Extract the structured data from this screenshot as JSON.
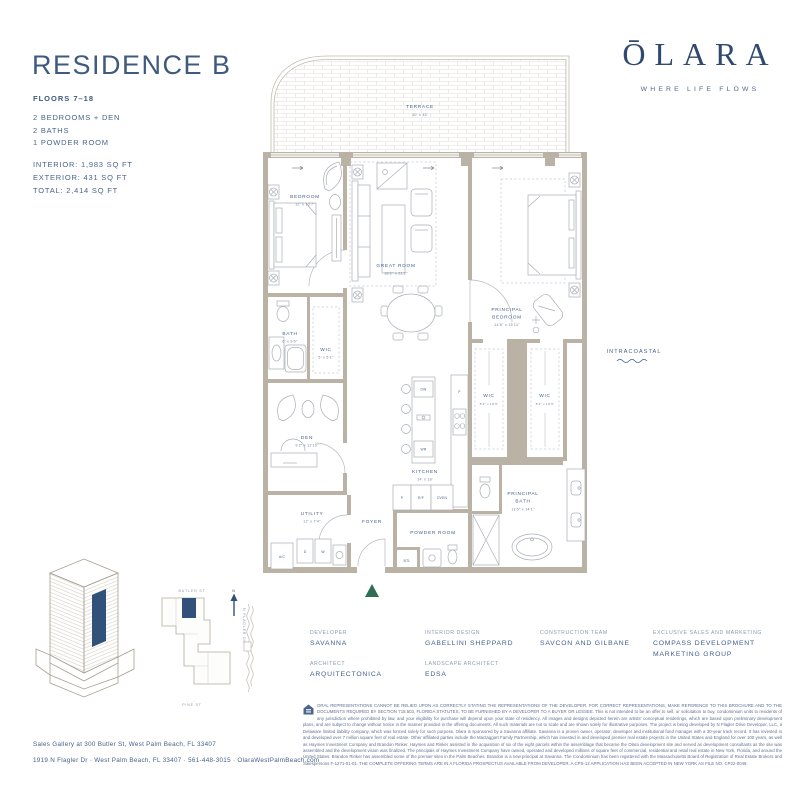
{
  "colors": {
    "navy": "#3e5a7e",
    "navy_dark": "#2f4a6e",
    "wall": "#b9b2a5",
    "green": "#2f6e55"
  },
  "header": {
    "title": "RESIDENCE B",
    "floors": "FLOORS 7–18",
    "features": [
      "2 BEDROOMS + DEN",
      "2 BATHS",
      "1 POWDER ROOM"
    ],
    "areas": [
      "INTERIOR: 1,983 SQ FT",
      "EXTERIOR: 431 SQ FT",
      "TOTAL: 2,414 SQ FT"
    ]
  },
  "brand": {
    "logo": "ŌLARA",
    "tagline": "WHERE LIFE FLOWS"
  },
  "floorplan": {
    "rooms": {
      "terrace": {
        "name": "TERRACE",
        "dims": "10' x 45'"
      },
      "bedroom": {
        "name": "BEDROOM",
        "dims": "12' x 13'7\""
      },
      "great_room": {
        "name": "GREAT ROOM",
        "dims": "18'2\" x 21'2\""
      },
      "principal_bedroom": {
        "line1": "PRINCIPAL",
        "line2": "BEDROOM",
        "dims": "14'8\" x 15'11\""
      },
      "bath": {
        "name": "BATH",
        "dims": "6' x 9'6\""
      },
      "wic_small": {
        "name": "WIC",
        "dims": "5' x 5'1\""
      },
      "den": {
        "name": "DEN",
        "dims": "9'2\" x 11'10\""
      },
      "utility": {
        "name": "UTILITY",
        "dims": "12' x 7'4\""
      },
      "kitchen": {
        "name": "KITCHEN",
        "dims": "14' x 18'"
      },
      "foyer": {
        "name": "FOYER"
      },
      "powder_room": {
        "name": "POWDER ROOM"
      },
      "wic_left": {
        "name": "WIC",
        "dims": "5'3\" x 10'3\""
      },
      "wic_right": {
        "name": "WIC",
        "dims": "5'3\" x 10'3\""
      },
      "principal_bath": {
        "line1": "PRINCIPAL",
        "line2": "BATH",
        "dims": "11'5\" x 14'1\""
      }
    },
    "fixtures": {
      "dw": "DW",
      "wr": "WR",
      "pantry": "P",
      "p": "P",
      "rf": "R/F",
      "oven": "OVEN",
      "btl": "BTL",
      "ac": "A/C",
      "d": "D",
      "w": "W"
    },
    "annotation": "INTRACOASTAL"
  },
  "keyplan": {
    "street_top": "BUTLER ST",
    "street_bottom": "PINE ST",
    "street_right": "N FLAGLER DR",
    "north_label": "N"
  },
  "credits": [
    {
      "label": "DEVELOPER",
      "value": "SAVANNA"
    },
    {
      "label": "ARCHITECT",
      "value": "ARQUITECTONICA"
    },
    {
      "label": "INTERIOR DESIGN",
      "value": "GABELLINI SHEPPARD"
    },
    {
      "label": "LANDSCAPE ARCHITECT",
      "value": "EDSA"
    },
    {
      "label": "CONSTRUCTION TEAM",
      "value": "SAVCON AND GILBANE"
    },
    {
      "label": "EXCLUSIVE SALES AND MARKETING",
      "value": "COMPASS DEVELOPMENT MARKETING GROUP"
    }
  ],
  "legal": "ORAL REPRESENTATIONS CANNOT BE RELIED UPON AS CORRECTLY STATING THE REPRESENTATIONS OF THE DEVELOPER. FOR CORRECT REPRESENTATIONS, MAKE REFERENCE TO THIS BROCHURE AND TO THE DOCUMENTS REQUIRED BY SECTION 718.503, FLORIDA STATUTES, TO BE FURNISHED BY A DEVELOPER TO A BUYER OR LESSEE. This is not intended to be an offer to sell, or solicitation to buy, condominium units to residents of any jurisdiction where prohibited by law, and your eligibility for purchase will depend upon your state of residency. All images and designs depicted herein are artists' conceptual renderings, which are based upon preliminary development plans, and are subject to change without notice in the manner provided in the offering documents. All such materials are not to scale and are shown solely for illustrative purposes. The project is being developed by N Flagler Drive Developer, LLC, a Delaware limited liability company, which was formed solely for such purpose. Olara is sponsored by a Savanna affiliate. Savanna is a proven owner, operator, developer and institutional fund manager with a 30-year track record. It has invested in and developed over 7 million square feet of real estate. Other affiliated parties include the Mactaggart Family Partnership, which has invested in and developed premier real estate projects in the United States and England for over 100 years, as well as Haymes Investment Company and Brandon Rinker. Haymes and Rinker assisted in the acquisition of six of the eight parcels within the assemblage that became the Olara development site and served as development consultants as the site was assembled and the development vision was finalized. The principals of Haymes Investment Company have owned, operated and developed millions of square feet of commercial, residential and retail real estate in New York, Florida, and around the United States. Brandon Rinker has assembled some of the premier sites in the Palm Beaches. Brandon is a new principal at Savanna. The Condominium has been registered with the Massachusetts Board of Registration of Real Estate Brokers and Salespersons F-1271-01-01. THE COMPLETE OFFERING TERMS ARE IN A FLORIDA PROSPECTUS AVAILABLE FROM DEVELOPER. A CPS-12 APPLICATION HAS BEEN ACCEPTED IN NEW YORK AS FILE NO. CP22-0049.",
  "footer": {
    "line1": "Sales Gallery at 300 Butler St, West Palm Beach, FL 33407",
    "line2": "1919 N Flagler Dr  ·  West Palm Beach, FL 33407  ·  561-448-3015  ·  OlaraWestPalmBeach.com"
  }
}
